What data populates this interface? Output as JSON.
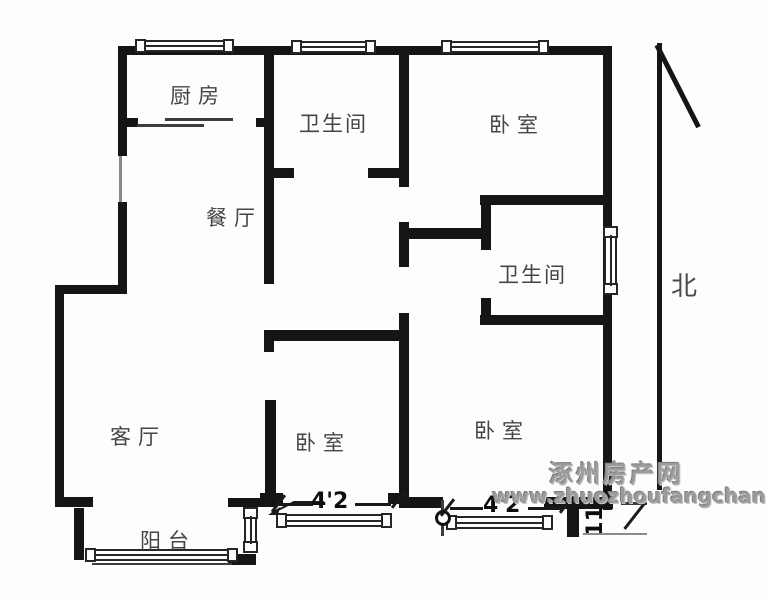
{
  "floorplan": {
    "rooms": [
      {
        "id": "kitchen",
        "label": "厨房"
      },
      {
        "id": "bathroom-top",
        "label": "卫生间"
      },
      {
        "id": "bedroom-top-right",
        "label": "卧室"
      },
      {
        "id": "dining-room",
        "label": "餐厅"
      },
      {
        "id": "bathroom-ensuite",
        "label": "卫生间"
      },
      {
        "id": "living-room",
        "label": "客厅"
      },
      {
        "id": "bedroom-bottom-middle",
        "label": "卧室"
      },
      {
        "id": "bedroom-bottom-right",
        "label": "卧室"
      },
      {
        "id": "balcony",
        "label": "阳台"
      }
    ],
    "dimensions": [
      {
        "id": "bedroom-bottom-middle-width",
        "label": "4'2"
      },
      {
        "id": "bedroom-bottom-right-width",
        "label": "4'2"
      },
      {
        "id": "bedroom-bottom-right-depth",
        "label": "11'"
      }
    ],
    "compass": {
      "north_label": "北"
    },
    "watermark": {
      "site_name": "涿州房产网",
      "site_url": "www.zhuozhoufangchan.com"
    },
    "colors": {
      "wall": "#151515",
      "room_label": "#454545",
      "watermark": "#9b9b9b"
    }
  }
}
